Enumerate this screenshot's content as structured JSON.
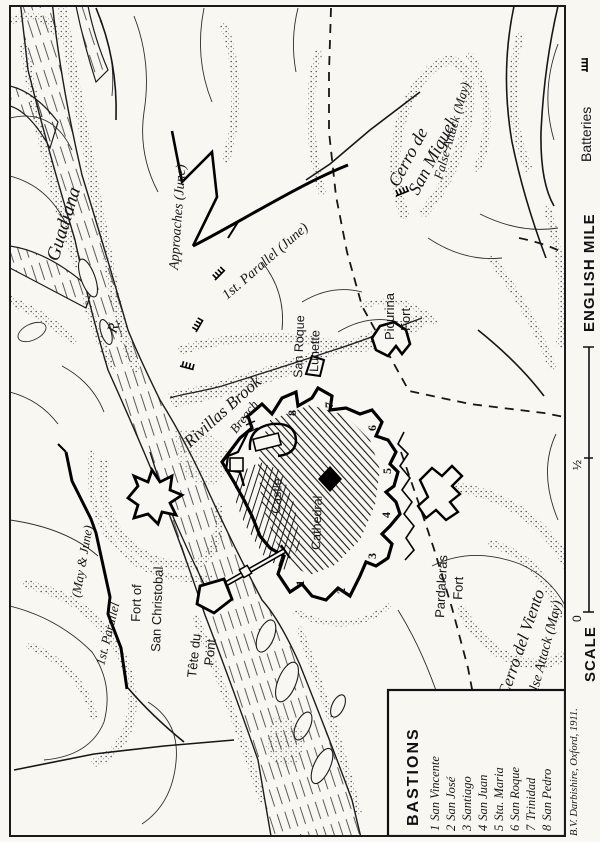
{
  "paper_color": "#f9f7f1",
  "ink_color": "#1c1c1c",
  "margin": {
    "batteries_label": "Batteries",
    "english_mile": "ENGLISH MILE",
    "scale_label": "SCALE",
    "scale_zero": "0",
    "scale_half": "½",
    "attribution": "B.V. Darbishire, Oxford, 1911."
  },
  "legend": {
    "title": "BASTIONS",
    "items": [
      {
        "num": "1",
        "name": "San Vincente"
      },
      {
        "num": "2",
        "name": "San José"
      },
      {
        "num": "3",
        "name": "Santiago"
      },
      {
        "num": "4",
        "name": "San Juan"
      },
      {
        "num": "5",
        "name": "Sta. Maria"
      },
      {
        "num": "6",
        "name": "San Roque"
      },
      {
        "num": "7",
        "name": "Trinidad"
      },
      {
        "num": "8",
        "name": "San Pedro"
      }
    ]
  },
  "labels": {
    "guadiana": "Guadiana",
    "river_abbrev": "R.",
    "approaches": "Approaches (June)",
    "first_parallel_june": "1st. Parallel (June)",
    "first_parallel_may_1": "1st. Parallel",
    "first_parallel_may_2": "(May & June)",
    "san_roque_1": "San Roque",
    "san_roque_2": "Lunette",
    "picurina_1": "Picurina",
    "picurina_2": "Fort",
    "rivillas_brook": "Rivillas Brook",
    "breach": "Breach",
    "castle": "Castle",
    "cathedral": "Cathedral",
    "fort_of": "Fort of",
    "san_christobal": "San Christobal",
    "tete_du": "Tête du",
    "pont": "Pont",
    "pardaleras_1": "Pardaleras",
    "pardaleras_2": "Fort",
    "cerro_viento": "Cerro del Viento",
    "false_attack_south": "False Attack (May)",
    "cerro_miguel_1": "Cerro de",
    "cerro_miguel_2": "San Miguel",
    "false_attack_north": "False Attack (May)"
  }
}
